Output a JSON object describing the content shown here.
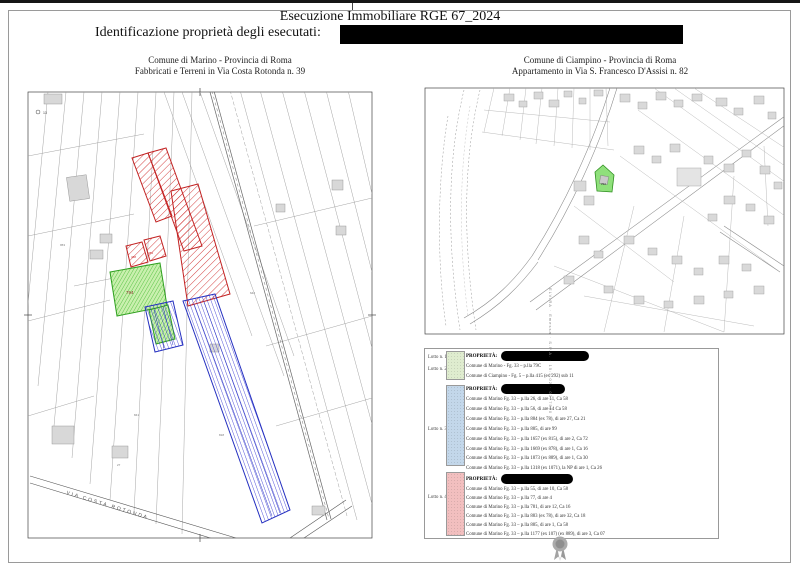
{
  "page": {
    "top_title": "Esecuzione Immobiliare RGE 67_2024",
    "subtitle": "Identificazione proprietà degli esecutati:"
  },
  "maps": {
    "left": {
      "header1": "Comune di Marino - Provincia di Roma",
      "header2": "Fabbricati e Terreni in Via Costa Rotonda n. 39",
      "street_label": "VIA COSTA ROTONDA",
      "green_parcel_label": "794",
      "corner_label": "13",
      "noise": {
        "n1": "642",
        "n2": "953",
        "n3": "841",
        "n4": "818",
        "n5": "27",
        "r1": "388",
        "r2": "389"
      }
    },
    "right": {
      "header1": "Comune di Ciampino - Provincia di Roma",
      "header2": "Appartamento in Via S. Francesco D'Assisi n. 82",
      "green_parcel_label": "292"
    }
  },
  "legend": {
    "lots": [
      "Lotto n. 1",
      "Lotto n. 2",
      "Lotto n. 3",
      "Lotto n. 4"
    ],
    "groups": [
      {
        "header": "PROPRIETÀ:",
        "lines": [
          "Comune di Marino - Fg. 33 – p.lla 79C",
          "Comune di Ciampino - Fg. 5 – p.lla 415 (ex 292) sub 11"
        ]
      },
      {
        "header": "PROPRIETÀ:",
        "lines": [
          "Comune di Marino Fg. 33 – p.lla 26, di are 11, Ca 58",
          "Comune di Marino Fg. 33 – p.lla 56, di are 14 Ca 58",
          "Comune di Marino Fg. 33 – p.lla 884 (ex 78), di are 27, Ca 21",
          "Comune di Marino Fg. 33 – p.lla 885, di are 99",
          "Comune di Marino Fg. 33 – p.lla 1657 (ex 815), di are 2, Ca 72",
          "Comune di Marino Fg. 33 – p.lla 1669 (ex 878), di are 1, Ca 16",
          "Comune di Marino Fg. 33 – p.lla 1873 (ex 889), di are 1, Ca 30",
          "Comune di Marino Fg. 33 – p.lla 1318 (ex 1071), la NP di are 1, Ca 26"
        ]
      },
      {
        "header": "PROPRIETÀ:",
        "lines": [
          "Comune di Marino Fg. 33 – p.lla 55, di are 10, Ca 58",
          "Comune di Marino Fg. 33 – p.lla 77, di are 4",
          "Comune di Marino Fg. 33 – p.lla 781, di are 12, Ca 16",
          "Comune di Marino Fg. 33 – p.lla 883 (ex 78), di are 32, Ca 18",
          "Comune di Marino Fg. 33 – p.lla 885, di are 1, Ca 58",
          "Comune di Marino Fg. 33 – p.lla 1177 (ex 107) (ex 889), di are 3, Ca 07"
        ]
      }
    ]
  },
  "watermark": "ELVIRA · Emessa · S.P.A. · 15:2:02 · 0377580",
  "colors": {
    "lot12_green": "#3fb82e",
    "lot3_blue": "#2b2bd0",
    "lot4_red": "#cf2b2b"
  }
}
